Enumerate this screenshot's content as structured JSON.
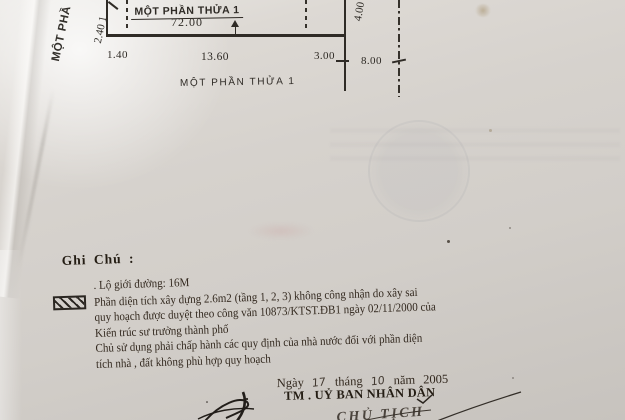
{
  "colors": {
    "paper": "#d6d2cd",
    "ink": "#2e2a25",
    "drawing_line": "#2f2b26",
    "stamp_bleed": "#7d8796"
  },
  "drawing": {
    "parcel_title": "MỘT PHẦN THỬA 1",
    "area_value": "72.00",
    "left_parcel_label_partial": "MỘT PHẦ",
    "left_dim": "2.40  1",
    "right_dim": "4.00",
    "road_dim": "8.00",
    "bottom_dims": [
      "1.40",
      "13.60",
      "3.00"
    ],
    "bottom_caption": "MỘT PHẦN THỬA 1"
  },
  "notes": {
    "heading": "Ghi Chú :",
    "road_line": ". Lộ giới đường: 16M",
    "hatch_lines": [
      "Phần diện tích xây dựng 2.6m2 (tầng 1, 2, 3) không công nhận do xây sai",
      "quy hoạch được duyệt theo công văn 10873/KTST.ĐB1 ngày 02/11/2000 của",
      "Kiến trúc sư trưởng thành phố",
      "Chủ sử dụng phải chấp hành các quy định của nhà nước đối với phần diện",
      "tích nhà , đất không phù hợp quy hoạch"
    ]
  },
  "footer": {
    "word_day": "Ngày",
    "day": "17",
    "word_month": "tháng",
    "month": "10",
    "word_year": "năm",
    "year": "2005",
    "authority": "TM . UỶ BAN NHÂN DÂN",
    "signer_title": "CHỦ TỊCH"
  }
}
